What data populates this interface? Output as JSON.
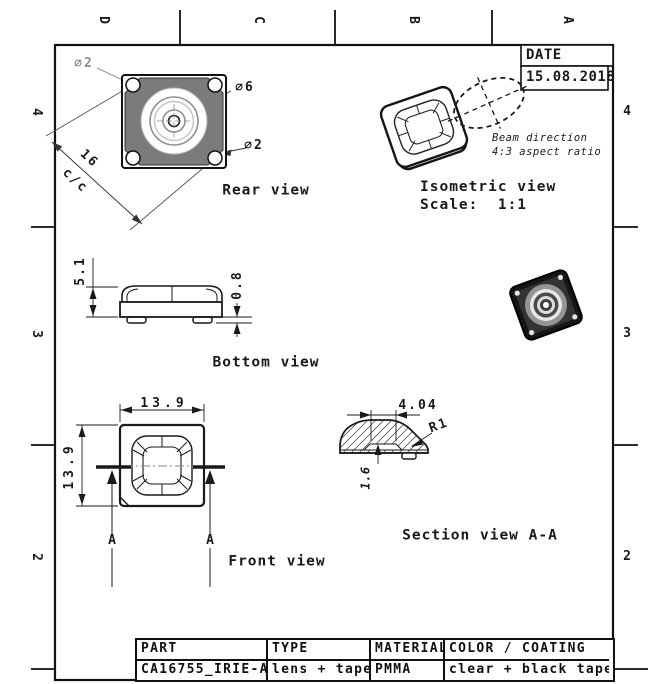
{
  "sheet": {
    "zones": {
      "columns": [
        "D",
        "C",
        "B",
        "A"
      ],
      "rows": [
        "4",
        "3",
        "2"
      ]
    },
    "title_block": {
      "date_label": "DATE",
      "date_value": "15.08.2018"
    },
    "views": {
      "rear": {
        "label": "Rear view",
        "dia2_top": "∅2",
        "dia6": "∅6",
        "dia2_bottom": "∅2",
        "pitch": "16",
        "pitch_note": "c/c"
      },
      "isometric": {
        "label": "Isometric view",
        "scale": "Scale:  1:1",
        "beam_note_1": "Beam direction",
        "beam_note_2": "4:3 aspect ratio"
      },
      "bottom": {
        "label": "Bottom view",
        "height": "5.1",
        "tape_height": "0.8"
      },
      "front": {
        "label": "Front view",
        "width": "13.9",
        "height": "13.9",
        "section_marker": "A"
      },
      "section": {
        "label": "Section view A-A",
        "inner_width": "4.04",
        "radius": "R1",
        "depth": "1.6"
      }
    },
    "table": {
      "headers": [
        "PART",
        "TYPE",
        "MATERIAL",
        "COLOR / COATING"
      ],
      "values": [
        "CA16755_IRIE-A",
        "lens + tape",
        "PMMA",
        "clear + black tape"
      ]
    },
    "colors": {
      "line": "#1a1a1a",
      "body_gray": "#7b7b7b",
      "dark_part": "#1c1c1c"
    }
  }
}
